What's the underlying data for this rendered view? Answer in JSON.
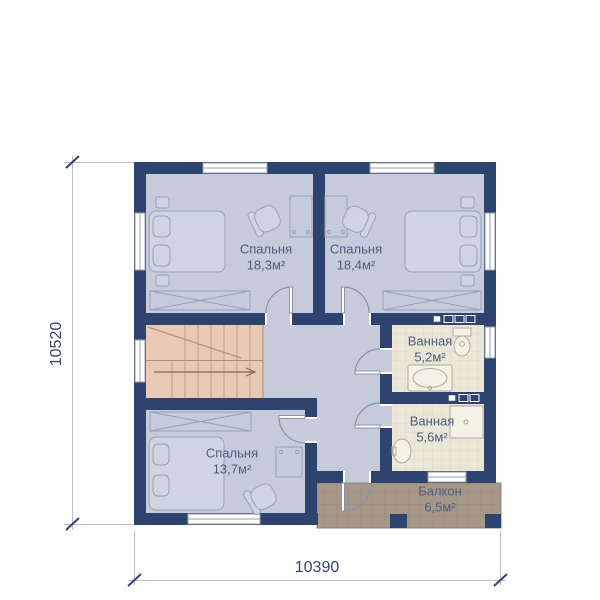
{
  "rooms": [
    {
      "id": "bedroom-1",
      "name": "Спальня",
      "area": "18,3м²"
    },
    {
      "id": "bedroom-2",
      "name": "Спальня",
      "area": "18,4м²"
    },
    {
      "id": "bathroom-1",
      "name": "Ванная",
      "area": "5,2м²"
    },
    {
      "id": "bathroom-2",
      "name": "Ванная",
      "area": "5,6м²"
    },
    {
      "id": "bedroom-3",
      "name": "Спальня",
      "area": "13,7м²"
    },
    {
      "id": "balcony",
      "name": "Балкон",
      "area": "6,5м²"
    }
  ],
  "dimensions": {
    "left": "10520",
    "bottom": "10390"
  },
  "colors": {
    "wall": "#2e436e",
    "floor": "#c5cbda",
    "furn": "#ced4e2",
    "furnline": "#98a1b8",
    "stairs": "#e9c9b3",
    "stairline": "#bd9f8d",
    "stairedge": "#a98f7c",
    "arrow": "#7d6a5d",
    "bath": "#ebe7d8",
    "bathgrid": "#ded8c5",
    "bathfix": "#f4f1e6",
    "bathline": "#b2ab94",
    "balcony": "#a69889",
    "balcgrid": "#8d8173",
    "door": "#8b93a8",
    "label": "#4e5c7e",
    "dim": "#2e4573",
    "dimline": "#b9bec7",
    "window": "#ffffff",
    "winframe": "#9aa0ad"
  }
}
